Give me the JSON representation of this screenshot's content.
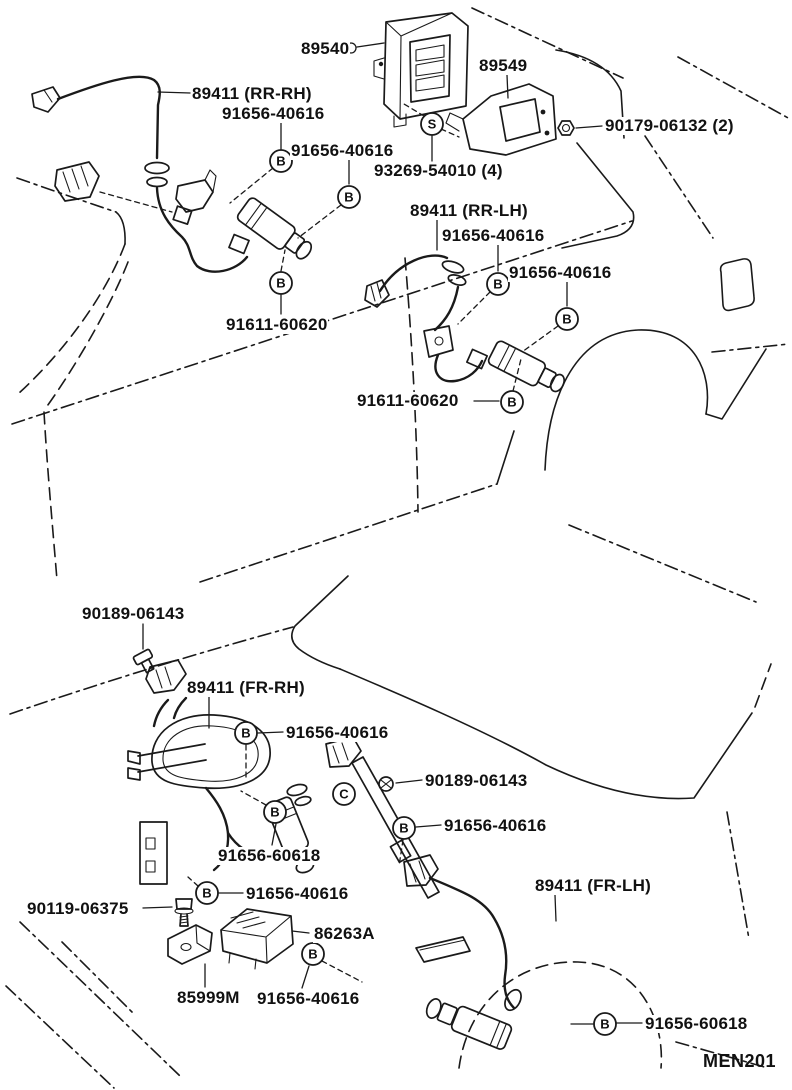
{
  "page": {
    "page_code": "MEN201",
    "background_color": "#ffffff",
    "line_color": "#1a1a1a"
  },
  "diagram": {
    "part_labels": [
      {
        "text": "89540",
        "x": 300,
        "y": 40
      },
      {
        "text": "89549",
        "x": 478,
        "y": 57
      },
      {
        "text": "90179-06132 (2)",
        "x": 604,
        "y": 117
      },
      {
        "text": "89411 (RR-RH)",
        "x": 191,
        "y": 85
      },
      {
        "text": "91656-40616",
        "x": 221,
        "y": 105
      },
      {
        "text": "91656-40616",
        "x": 290,
        "y": 142
      },
      {
        "text": "93269-54010 (4)",
        "x": 373,
        "y": 162
      },
      {
        "text": "89411 (RR-LH)",
        "x": 409,
        "y": 202
      },
      {
        "text": "91656-40616",
        "x": 441,
        "y": 227
      },
      {
        "text": "91656-40616",
        "x": 508,
        "y": 264
      },
      {
        "text": "91611-60620",
        "x": 225,
        "y": 316
      },
      {
        "text": "91611-60620",
        "x": 356,
        "y": 392
      },
      {
        "text": "90189-06143",
        "x": 81,
        "y": 605
      },
      {
        "text": "89411 (FR-RH)",
        "x": 186,
        "y": 679
      },
      {
        "text": "91656-40616",
        "x": 285,
        "y": 724
      },
      {
        "text": "90189-06143",
        "x": 424,
        "y": 772
      },
      {
        "text": "91656-40616",
        "x": 443,
        "y": 817
      },
      {
        "text": "91656-60618",
        "x": 217,
        "y": 847
      },
      {
        "text": "91656-40616",
        "x": 245,
        "y": 885
      },
      {
        "text": "90119-06375",
        "x": 26,
        "y": 900
      },
      {
        "text": "86263A",
        "x": 313,
        "y": 925
      },
      {
        "text": "85999M",
        "x": 176,
        "y": 989
      },
      {
        "text": "91656-40616",
        "x": 256,
        "y": 990
      },
      {
        "text": "89411 (FR-LH)",
        "x": 534,
        "y": 877
      },
      {
        "text": "91656-60618",
        "x": 644,
        "y": 1015
      }
    ],
    "fastener_markers": [
      {
        "letter": "B",
        "x": 281,
        "y": 161
      },
      {
        "letter": "B",
        "x": 349,
        "y": 197
      },
      {
        "letter": "B",
        "x": 281,
        "y": 283
      },
      {
        "letter": "S",
        "x": 432,
        "y": 124
      },
      {
        "letter": "B",
        "x": 498,
        "y": 284
      },
      {
        "letter": "B",
        "x": 567,
        "y": 319
      },
      {
        "letter": "B",
        "x": 512,
        "y": 402
      },
      {
        "letter": "B",
        "x": 246,
        "y": 733
      },
      {
        "letter": "B",
        "x": 275,
        "y": 812
      },
      {
        "letter": "C",
        "x": 344,
        "y": 794
      },
      {
        "letter": "B",
        "x": 404,
        "y": 828
      },
      {
        "letter": "B",
        "x": 207,
        "y": 893
      },
      {
        "letter": "B",
        "x": 313,
        "y": 954
      },
      {
        "letter": "B",
        "x": 605,
        "y": 1024
      }
    ]
  }
}
